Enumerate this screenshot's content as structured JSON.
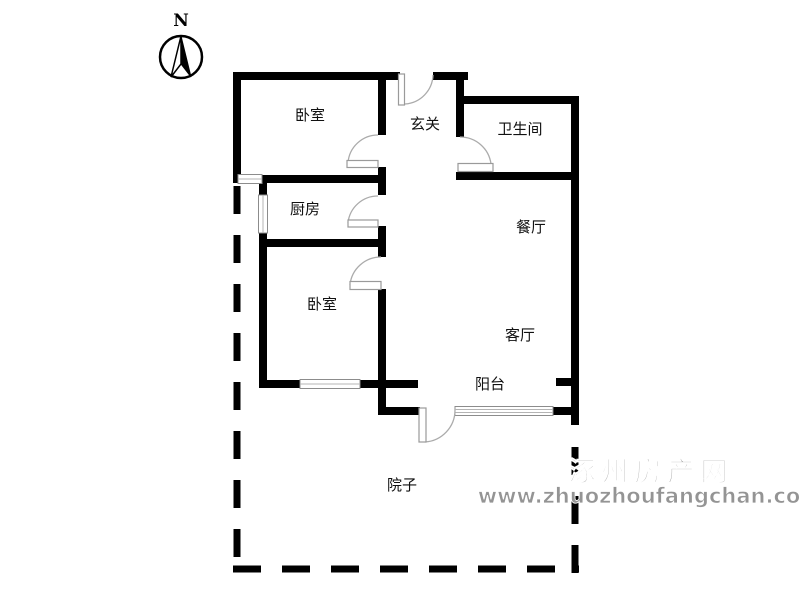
{
  "compass": {
    "label": "N"
  },
  "rooms": {
    "bedroom1": "卧室",
    "hallway": "玄关",
    "bathroom": "卫生间",
    "kitchen": "厨房",
    "dining": "餐厅",
    "bedroom2": "卧室",
    "living": "客厅",
    "balcony": "阳台",
    "yard": "院子"
  },
  "watermark": {
    "site_name": "涿州房产网",
    "url": "www.zhuozhoufangchan.com"
  },
  "colors": {
    "background": "#ffffff",
    "wall": "#000000",
    "window_frame": "#8c8c8c",
    "door": "#ababab",
    "label_text": "#111111",
    "watermark_gray": "#949494"
  }
}
